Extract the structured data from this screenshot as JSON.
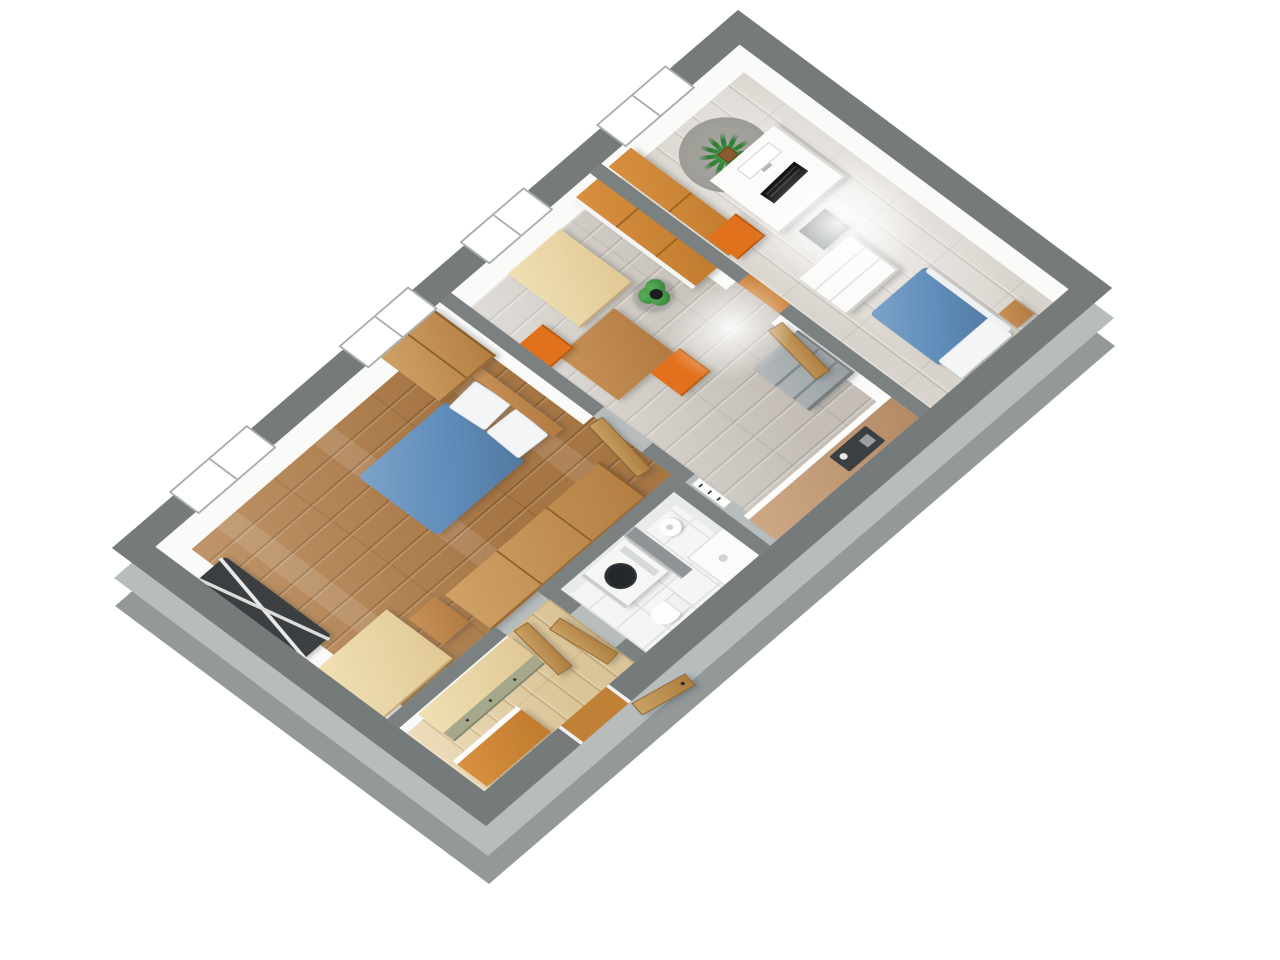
{
  "scene": {
    "type": "3d-floor-plan-render",
    "view": "rotated top-down 3d view of a one-bedroom apartment, no visible text or UI chrome",
    "background": "#ffffff"
  },
  "colors": {
    "page_bg": "#ffffff",
    "wall_top": "#7b8081",
    "wall_exterior": "#757a7b",
    "wall_stub": "#8f9596",
    "wall_side_light": "#b7bcbc",
    "wall_side_mid": "#939999",
    "floor_oak": "#b27e49",
    "floor_gray_wood": "#ccc6be",
    "floor_pale_wood": "#e6cfa0",
    "floor_tile": "#f5f5f3",
    "furniture_oak": "#c08a52",
    "furniture_pale": "#ead9ae",
    "furniture_khaki": "#a6a88b",
    "accent_orange": "#e2711d",
    "counter_tan": "#c09a76",
    "bed_blue": "#5f8cba",
    "fridge_gray": "#a5abad",
    "plant_green": "#3f8f3f"
  },
  "windows": {
    "count": 4,
    "location": "north-west exterior wall"
  },
  "doors": {
    "count": 5,
    "entry_door_state": "open, swung outside through south-east wall"
  },
  "rooms": [
    {
      "name": "bedroom",
      "floor": "oak wood",
      "furniture": [
        "double-bed-blue",
        "wardrobe",
        "long-sideboard",
        "pale-desk",
        "stool",
        "drying-rack",
        "interior-door"
      ]
    },
    {
      "name": "kitchen-dining",
      "floor": "gray wood",
      "furniture": [
        "dining-table",
        "orange-chair-x2",
        "dresser",
        "tall-cabinet-row-wood-top",
        "floor-plant",
        "fridge",
        "kitchen-counter-with-sink",
        "radiator",
        "interior-door"
      ]
    },
    {
      "name": "study-bedroom",
      "floor": "gray wood",
      "furniture": [
        "wood-sideboard",
        "white-desk",
        "monitor",
        "keyboard",
        "orange-chair",
        "dark-side-table",
        "white-chest-of-drawers",
        "single-bed-blue",
        "nightstand",
        "palm-plant",
        "round-rug"
      ]
    },
    {
      "name": "bathroom",
      "floor": "white tile",
      "furniture": [
        "washing-machine",
        "partition-stub-wall",
        "pedestal-sink",
        "toilet",
        "shower-tray"
      ]
    },
    {
      "name": "hallway",
      "floor": "pale wood",
      "furniture": [
        "cabinet-row-khaki-front",
        "orange-desk",
        "entry-door"
      ]
    }
  ]
}
